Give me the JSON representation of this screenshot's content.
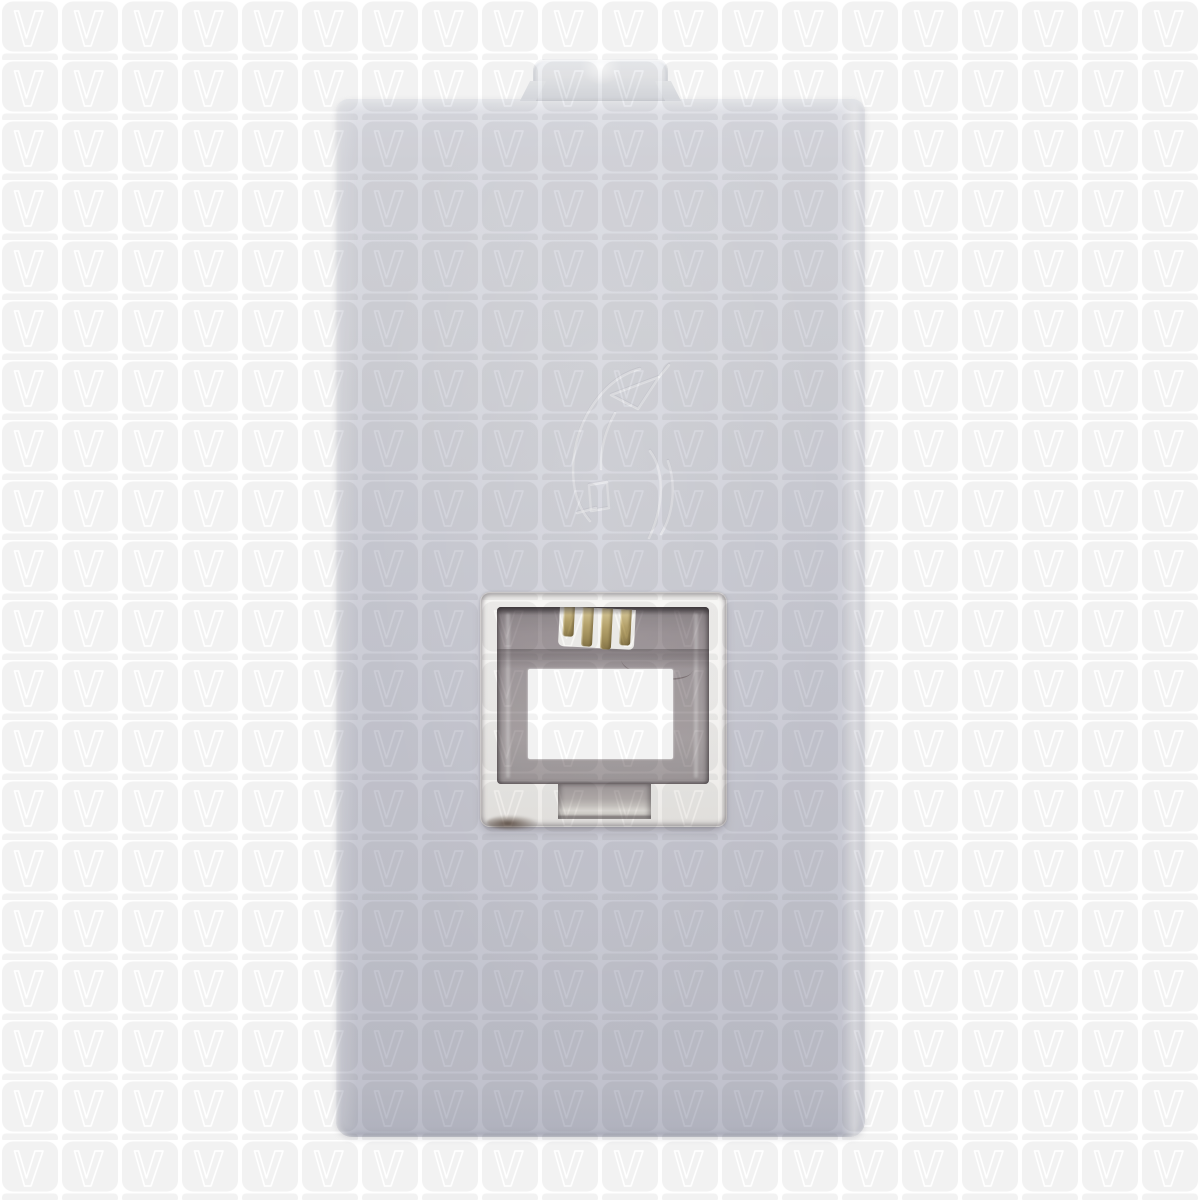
{
  "meta": {
    "description": "Product photograph of a white single-module telephone RJ11 socket insert, shown on a repeating V-logo watermark background",
    "visible_text": ""
  },
  "colors": {
    "background": "#ffffff",
    "watermark_tile": "#f2f2f2",
    "watermark_stroke": "#ffffff",
    "plate_top": "#e0e1e7",
    "plate_upper": "#d5d6dd",
    "plate_lower": "#c7c8d2",
    "plate_bottom": "#b9bbc7",
    "clip_top": "#f1f3f6",
    "clip_bottom": "#dcdee3",
    "bezel": "#f4f3f1",
    "cavity_dark": "#847c80",
    "cavity_mid": "#a1999c",
    "cavity_light": "#a7a0a2",
    "window": "#ffffff",
    "pin_light": "#e2d3a2",
    "pin_mid": "#bfab72",
    "pin_dark": "#8c7a4b",
    "pin_bed": "#f7f6f3",
    "notch_mid": "#b5afae",
    "notch_light": "#e3e0db",
    "spot_dark": "rgba(74,56,44,0.8)",
    "icon_stroke": "rgba(255,255,255,0.5)",
    "icon_shadow": "rgba(135,135,150,0.35)"
  },
  "watermark": {
    "glyph": "V",
    "icon_name": "v-logo-icon",
    "tile_size_px": 60,
    "pattern": "rounded square tile with hollow V outline and underline bar, tiled over entire image including the product"
  },
  "product": {
    "name": "telephone-socket-module",
    "jack_type": "RJ11",
    "pin_count": 4,
    "features": [
      "top mounting clip tab",
      "embossed telephone handset icon",
      "recessed jack opening with gold contacts",
      "connector latch notch"
    ]
  }
}
